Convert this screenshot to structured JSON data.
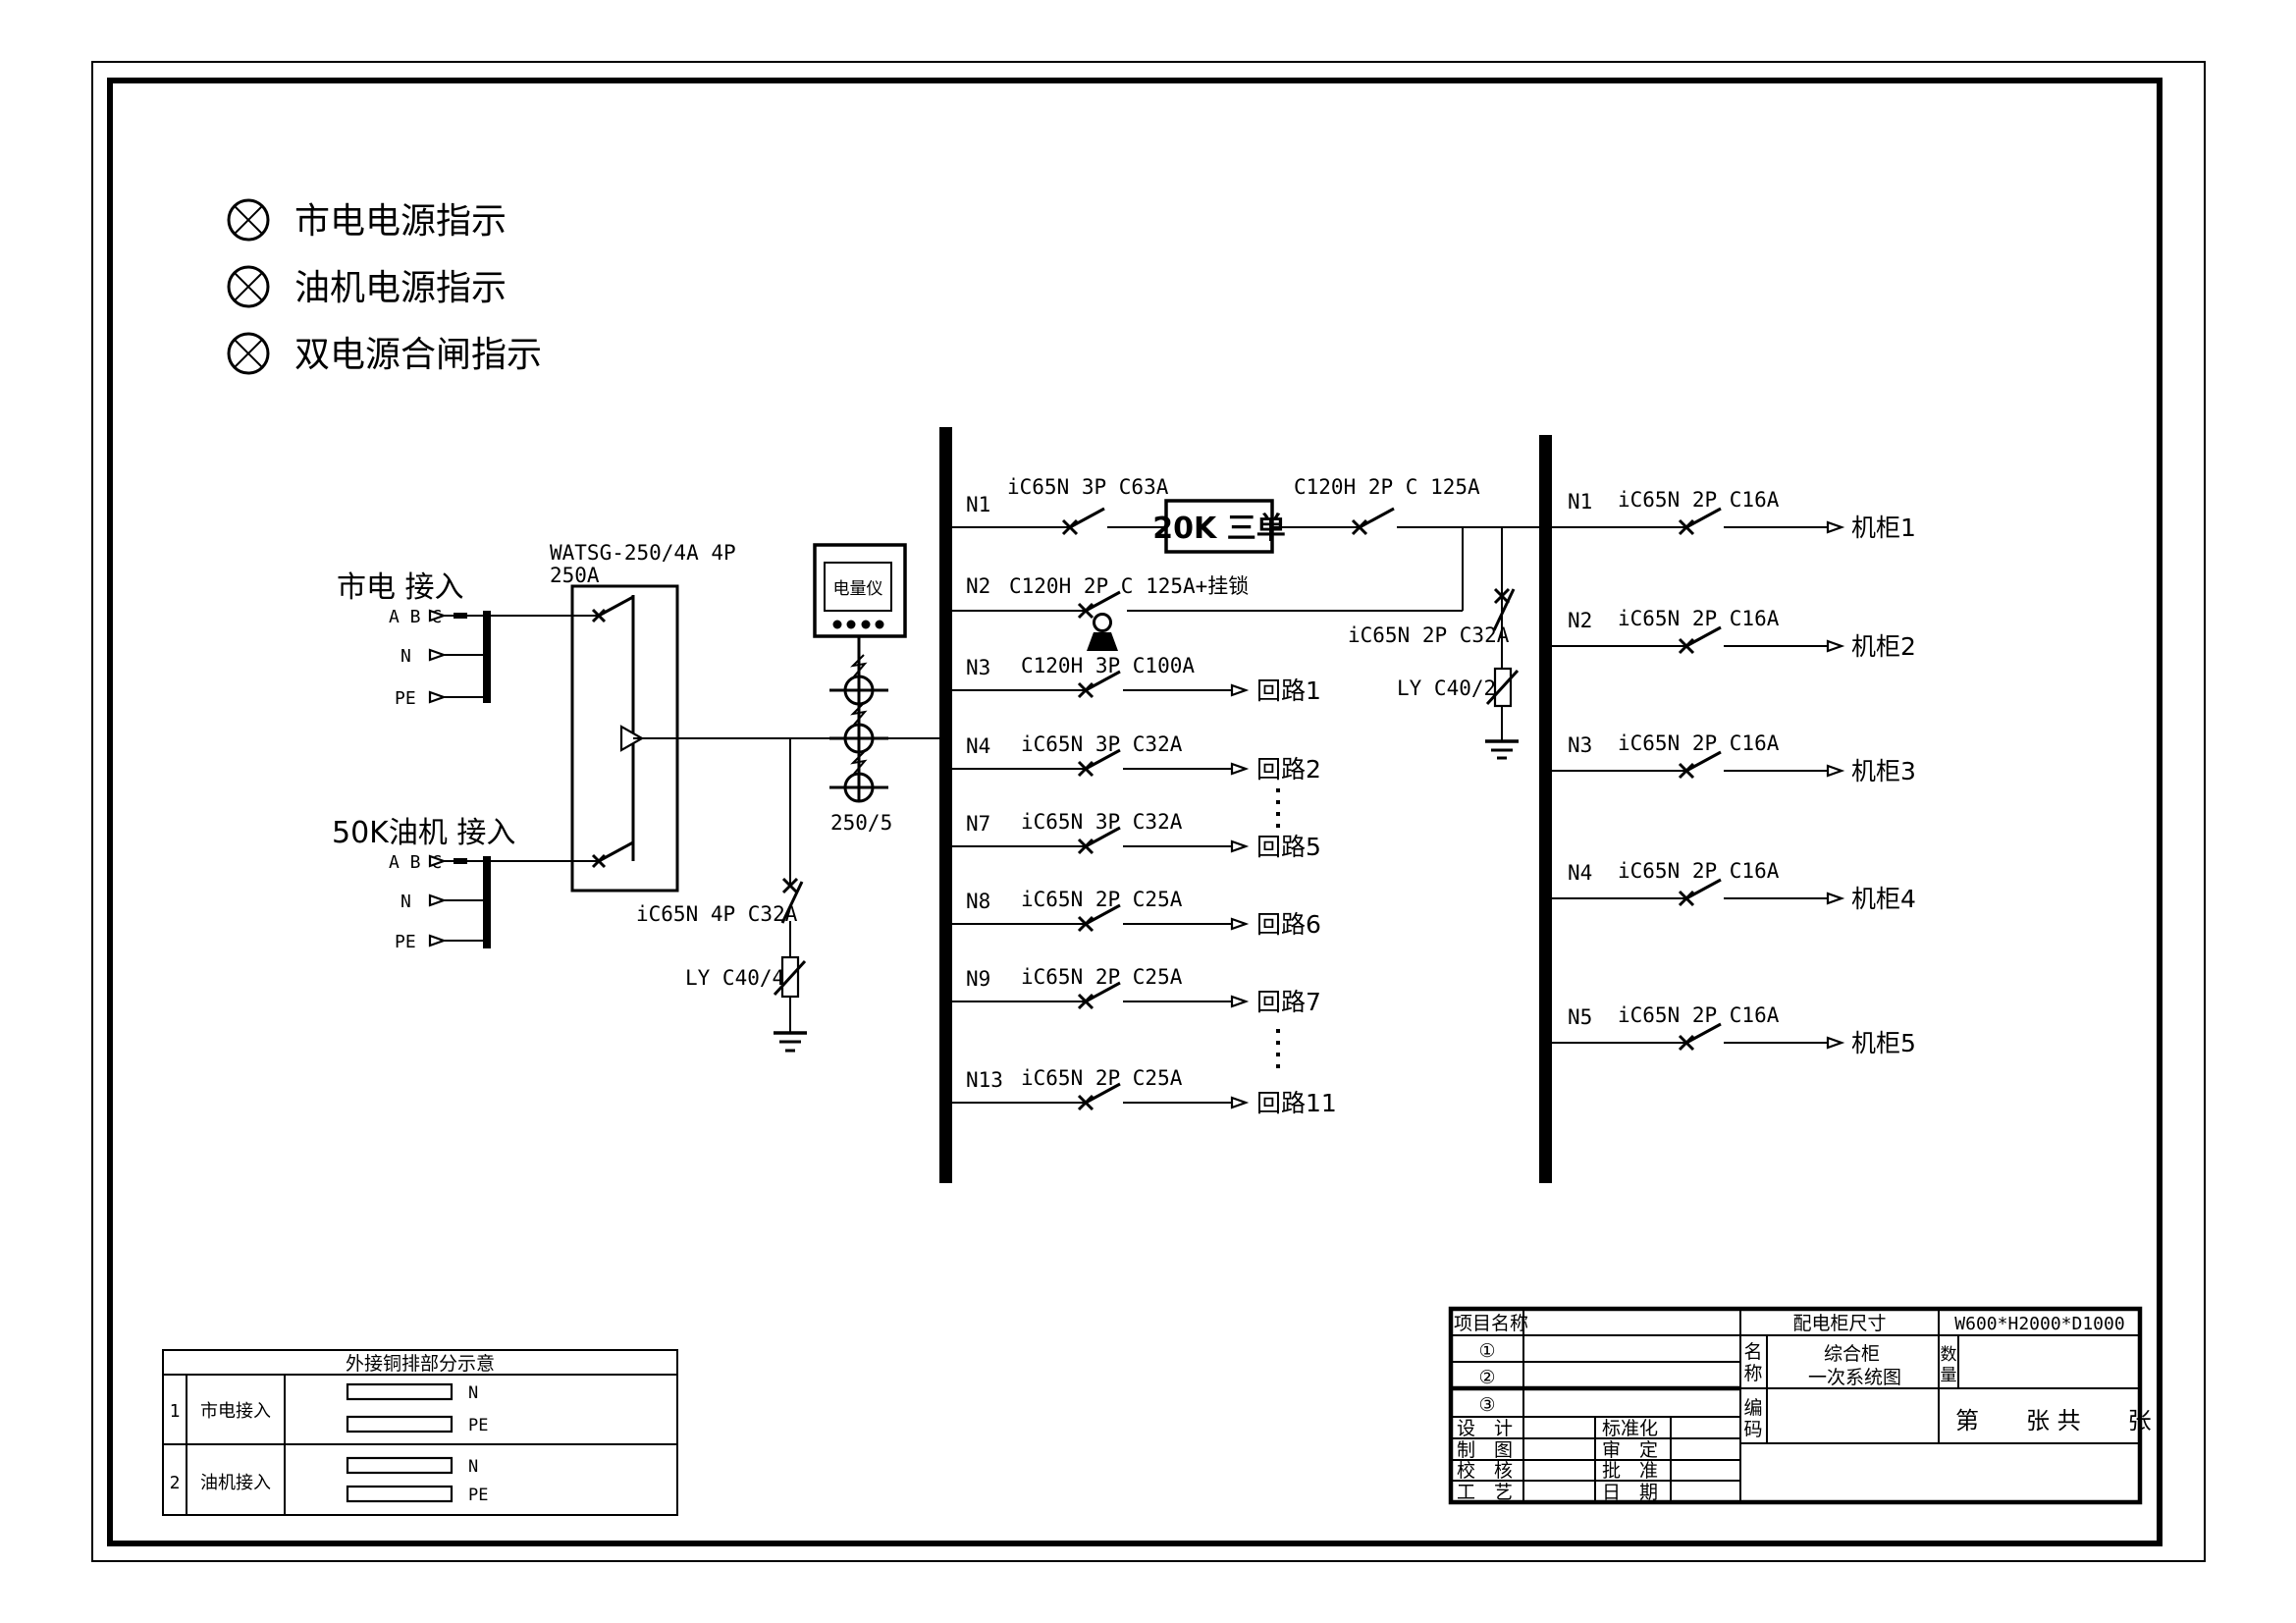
{
  "legend": {
    "items": [
      {
        "label": "市电电源指示"
      },
      {
        "label": "油机电源指示"
      },
      {
        "label": "双电源合闸指示"
      }
    ]
  },
  "sources": {
    "mains": {
      "title": "市电 接入",
      "phase": "A B C",
      "neutral": "N",
      "earth": "PE"
    },
    "genset": {
      "title": "50K油机 接入",
      "phase": "A B C",
      "neutral": "N",
      "earth": "PE"
    }
  },
  "ats": {
    "model": "WATSG-250/4A 4P",
    "rating": "250A"
  },
  "meter": {
    "label": "电量仪",
    "ct_ratio": "250/5"
  },
  "main_spd": {
    "breaker": "iC65N 4P C32A",
    "arrester": "LY C40/4"
  },
  "bus_spd": {
    "breaker": "iC65N 2P C32A",
    "arrester": "LY C40/2"
  },
  "ups_box": {
    "label": "20K 三单"
  },
  "left_feeders": [
    {
      "id": "N1",
      "spec": "iC65N 3P C63A",
      "spec2": "C120H 2P C 125A"
    },
    {
      "id": "N2",
      "spec": "C120H 2P C 125A+挂锁"
    },
    {
      "id": "N3",
      "spec": "C120H 3P C100A",
      "dest": "回路1"
    },
    {
      "id": "N4",
      "spec": "iC65N 3P C32A",
      "dest": "回路2"
    },
    {
      "id": "N7",
      "spec": "iC65N 3P C32A",
      "dest": "回路5"
    },
    {
      "id": "N8",
      "spec": "iC65N 2P C25A",
      "dest": "回路6"
    },
    {
      "id": "N9",
      "spec": "iC65N 2P C25A",
      "dest": "回路7"
    },
    {
      "id": "N13",
      "spec": "iC65N 2P C25A",
      "dest": "回路11"
    }
  ],
  "right_feeders": [
    {
      "id": "N1",
      "spec": "iC65N 2P C16A",
      "dest": "机柜1"
    },
    {
      "id": "N2",
      "spec": "iC65N 2P C16A",
      "dest": "机柜2"
    },
    {
      "id": "N3",
      "spec": "iC65N 2P C16A",
      "dest": "机柜3"
    },
    {
      "id": "N4",
      "spec": "iC65N 2P C16A",
      "dest": "机柜4"
    },
    {
      "id": "N5",
      "spec": "iC65N 2P C16A",
      "dest": "机柜5"
    }
  ],
  "busbar_table": {
    "title": "外接铜排部分示意",
    "rows": [
      {
        "no": "1",
        "name": "市电接入",
        "bar1": "N",
        "bar2": "PE"
      },
      {
        "no": "2",
        "name": "油机接入",
        "bar1": "N",
        "bar2": "PE"
      }
    ]
  },
  "title_block": {
    "project_label": "项目名称",
    "item1": "①",
    "item2": "②",
    "item3": "③",
    "design": "设　计",
    "drawn": "制　图",
    "checked": "校　核",
    "process": "工　艺",
    "standard": "标准化",
    "approved": "审　定",
    "ratified": "批　准",
    "date": "日　期",
    "cabinet_size_label": "配电柜尺寸",
    "cabinet_size": "W600*H2000*D1000",
    "name_chars": [
      "名",
      "称"
    ],
    "name_line1": "综合柜",
    "name_line2": "一次系统图",
    "qty_chars": [
      "数",
      "量"
    ],
    "code_chars": [
      "编",
      "码"
    ],
    "sheet": "第　　张 共　　张"
  },
  "colors": {
    "ink": "#000000",
    "paper": "#ffffff"
  }
}
